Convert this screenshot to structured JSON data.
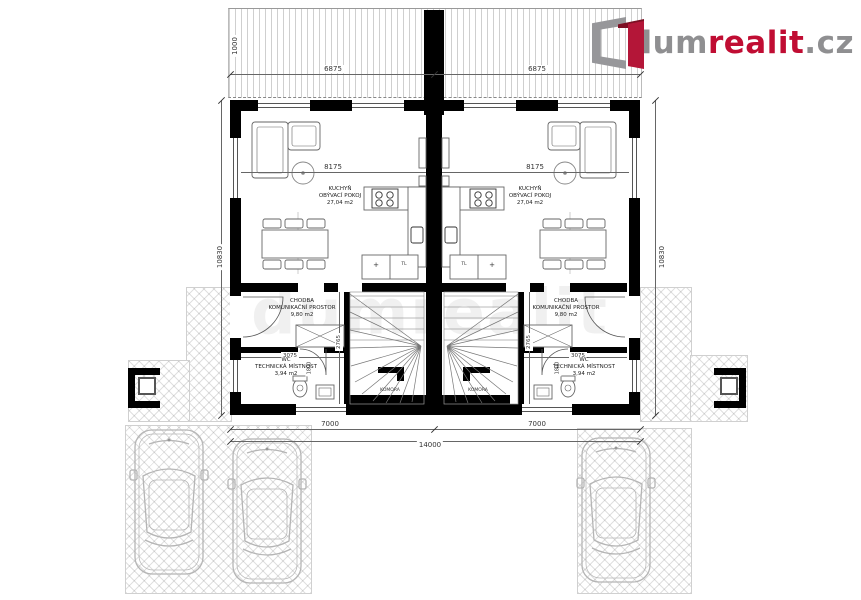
{
  "logo": {
    "dum": "dum",
    "realit": "realit",
    "cz": ".cz"
  },
  "watermark": "dumrealit",
  "colors": {
    "brand_red": "#c00d33",
    "brand_gray": "#8f8f91",
    "wall_black": "#000000",
    "hatch_gray": "#d0d0d0",
    "car_gray": "#b5b5b5"
  },
  "dims": {
    "top_left": "6875",
    "top_right": "6875",
    "side_left": "10830",
    "side_right": "10830",
    "bottom_left": "7000",
    "bottom_right": "7000",
    "bottom_total": "14000",
    "living_left": "8175",
    "living_right": "8175",
    "hall_left": "3075",
    "hall_right": "3075",
    "bath_left": "2765",
    "bath_right": "2765",
    "door_left": "1800",
    "door_right": "1800",
    "corner_left": "1000",
    "corner_right": "1000"
  },
  "rooms": {
    "living": {
      "l1": "KUCHYŇ",
      "l2": "OBÝVACÍ POKOJ",
      "l3": "27,04 m2"
    },
    "hall": {
      "l1": "CHODBA",
      "l2": "KOMUNIKAČNÍ PROSTOR",
      "l3": "9,80 m2"
    },
    "wc": {
      "l1": "WC",
      "l2": "TECHNICKÁ MÍSTNOST",
      "l3": "3,94 m2"
    },
    "stair_closet": "KOMORA",
    "fridge": "+",
    "washer": "TL"
  }
}
